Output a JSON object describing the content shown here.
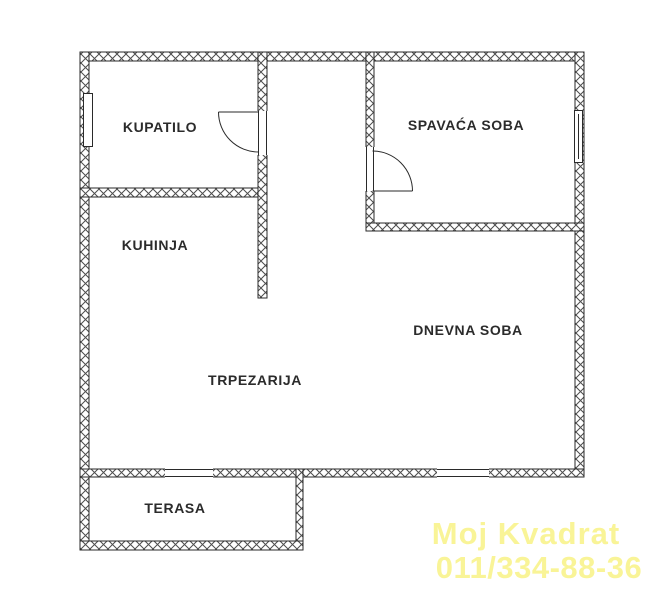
{
  "plan": {
    "title": "apartment-floor-plan",
    "rooms": {
      "kupatilo": {
        "label": "KUPATILO"
      },
      "spavaca": {
        "label": "SPAVAĆA SOBA"
      },
      "kuhinja": {
        "label": "KUHINJA"
      },
      "dnevna": {
        "label": "DNEVNA SOBA"
      },
      "trpezarija": {
        "label": "TRPEZARIJA"
      },
      "terasa": {
        "label": "TERASA"
      }
    },
    "features": {
      "doors": [
        "bathroom-door",
        "bedroom-door"
      ],
      "windows": [
        "bathroom-window",
        "bedroom-window",
        "living-room-window"
      ],
      "openings": [
        "terrace-door-opening",
        "living-room-window-opening"
      ]
    }
  },
  "watermark": {
    "line1": "Moj Kvadrat",
    "line2": "011/334-88-36",
    "color": "#f9f492"
  },
  "colors": {
    "background": "#ffffff",
    "wall_outline": "#2a2a2a",
    "wall_hatch": "#4d4d4d",
    "room_label": "#2b2b2b",
    "watermark": "#f9f492"
  }
}
